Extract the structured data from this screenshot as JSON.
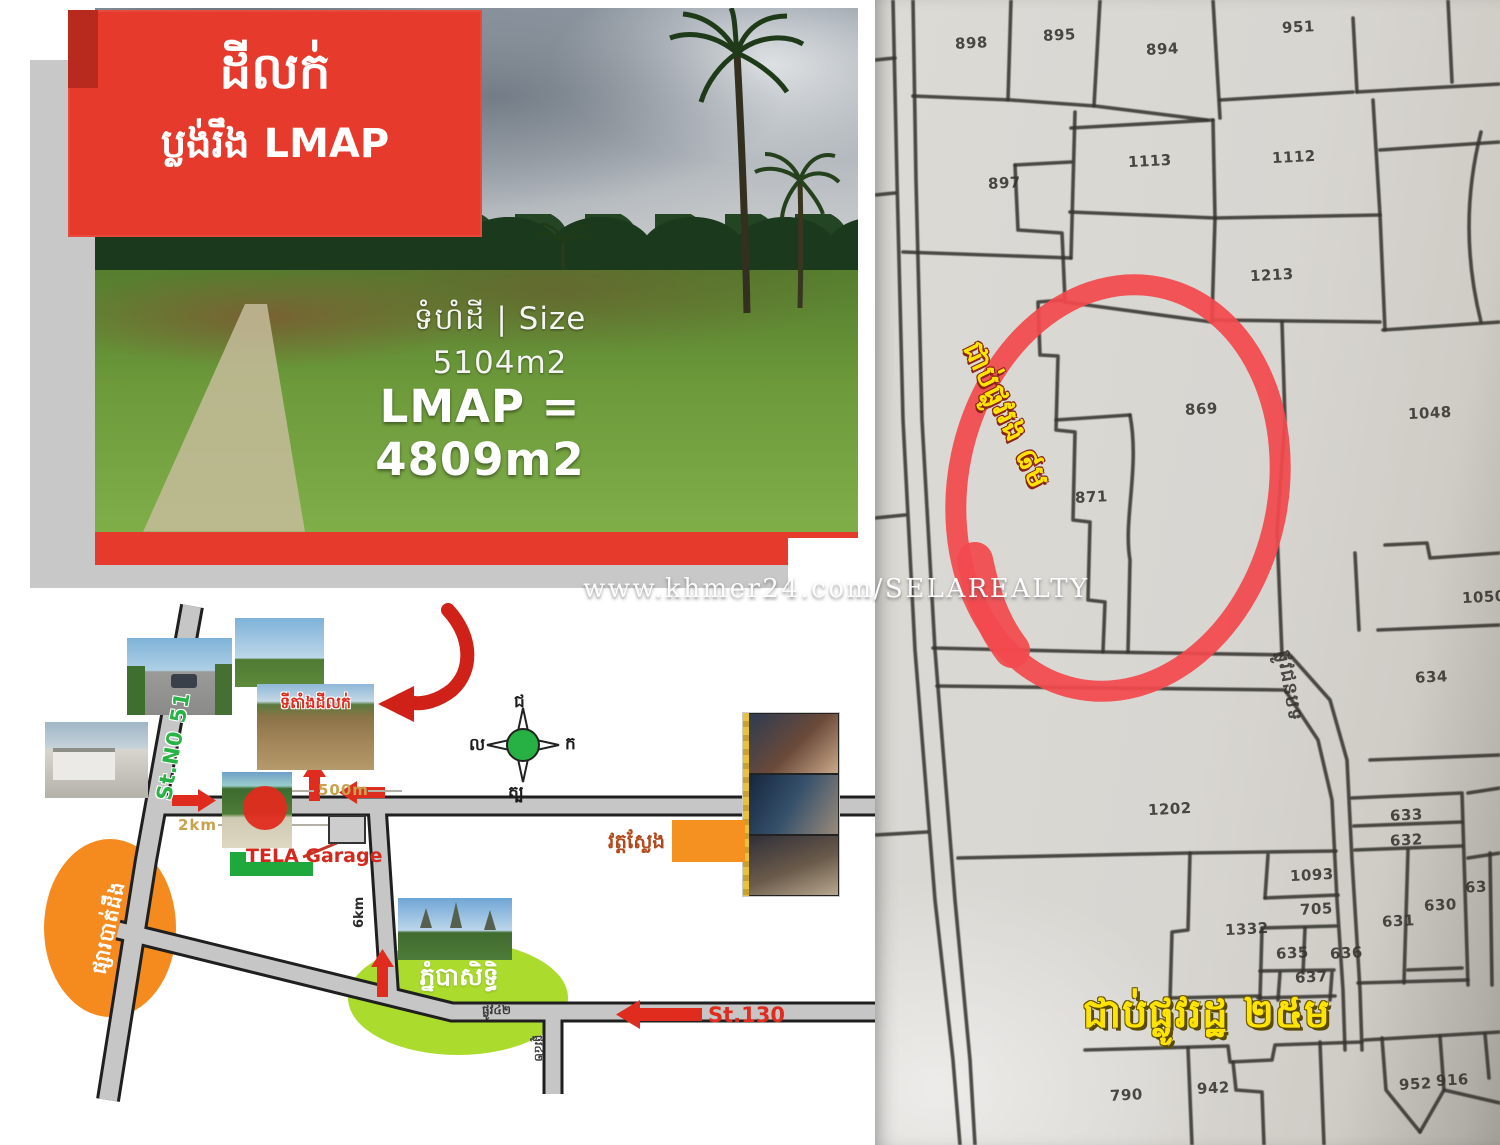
{
  "watermark": "www.khmer24.com/SELAREALTY",
  "colors": {
    "banner_red": "#e53a2c",
    "highlight_red": "#f2494e",
    "accent_yellow": "#ffe400",
    "street51_green": "#29b347",
    "st130_red": "#e02b1f",
    "market_orange": "#f58a1e",
    "phnom_lime": "#abdc2d",
    "tela_green": "#1fa83c"
  },
  "listing_card": {
    "title": "ដីលក់",
    "subtitle": "ប្លង់រឹង LMAP",
    "size_line": "ទំហំដី | Size 5104m2",
    "lmap_line": "LMAP = 4809m2"
  },
  "sketch_map": {
    "site_label": "ទីតាំងដីលក់",
    "street_51": "St.N0 51",
    "street_130": "St.130",
    "street_42_h": "ផ្លូវ៤២",
    "street_42_v": "ផ្លូវ៤២",
    "dist_500m": "500m",
    "dist_2km": "2km",
    "dist_6km": "6km",
    "tela_garage": "TELA Garage",
    "market_batdoeung": "ផ្សារបាត់ដឹង",
    "phnom_baset": "ភ្នំបាសិទ្ធិ",
    "wat_sleng": "វត្តស្លែង",
    "compass": {
      "north": "ជ",
      "south": "ត្ប",
      "east": "ក",
      "west": "ល"
    }
  },
  "cadastral_map": {
    "note_secondary_road": "ជាប់ផ្លូវរង ៨ម",
    "note_state_road": "ជាប់ផ្លូវរដ្ឋ ២៥ម",
    "road_side_label": "ផ្លូវជនបទ",
    "parcels": [
      {
        "n": "898",
        "x": 955,
        "y": 34
      },
      {
        "n": "895",
        "x": 1043,
        "y": 26
      },
      {
        "n": "894",
        "x": 1146,
        "y": 40
      },
      {
        "n": "951",
        "x": 1282,
        "y": 18
      },
      {
        "n": "897",
        "x": 988,
        "y": 174
      },
      {
        "n": "1113",
        "x": 1128,
        "y": 152
      },
      {
        "n": "1112",
        "x": 1272,
        "y": 148
      },
      {
        "n": "1213",
        "x": 1250,
        "y": 266
      },
      {
        "n": "869",
        "x": 1185,
        "y": 400
      },
      {
        "n": "871",
        "x": 1075,
        "y": 488
      },
      {
        "n": "1048",
        "x": 1408,
        "y": 404
      },
      {
        "n": "1050",
        "x": 1462,
        "y": 588
      },
      {
        "n": "634",
        "x": 1415,
        "y": 668
      },
      {
        "n": "1202",
        "x": 1148,
        "y": 800
      },
      {
        "n": "633",
        "x": 1390,
        "y": 806
      },
      {
        "n": "632",
        "x": 1390,
        "y": 831
      },
      {
        "n": "1093",
        "x": 1290,
        "y": 866
      },
      {
        "n": "705",
        "x": 1300,
        "y": 900
      },
      {
        "n": "1332",
        "x": 1225,
        "y": 920
      },
      {
        "n": "631",
        "x": 1382,
        "y": 912
      },
      {
        "n": "630",
        "x": 1424,
        "y": 896
      },
      {
        "n": "63",
        "x": 1465,
        "y": 878
      },
      {
        "n": "635",
        "x": 1276,
        "y": 944
      },
      {
        "n": "636",
        "x": 1330,
        "y": 944
      },
      {
        "n": "637",
        "x": 1295,
        "y": 968
      },
      {
        "n": "790",
        "x": 1110,
        "y": 1086
      },
      {
        "n": "942",
        "x": 1197,
        "y": 1079
      },
      {
        "n": "952",
        "x": 1399,
        "y": 1075
      },
      {
        "n": "916",
        "x": 1436,
        "y": 1071
      }
    ]
  }
}
